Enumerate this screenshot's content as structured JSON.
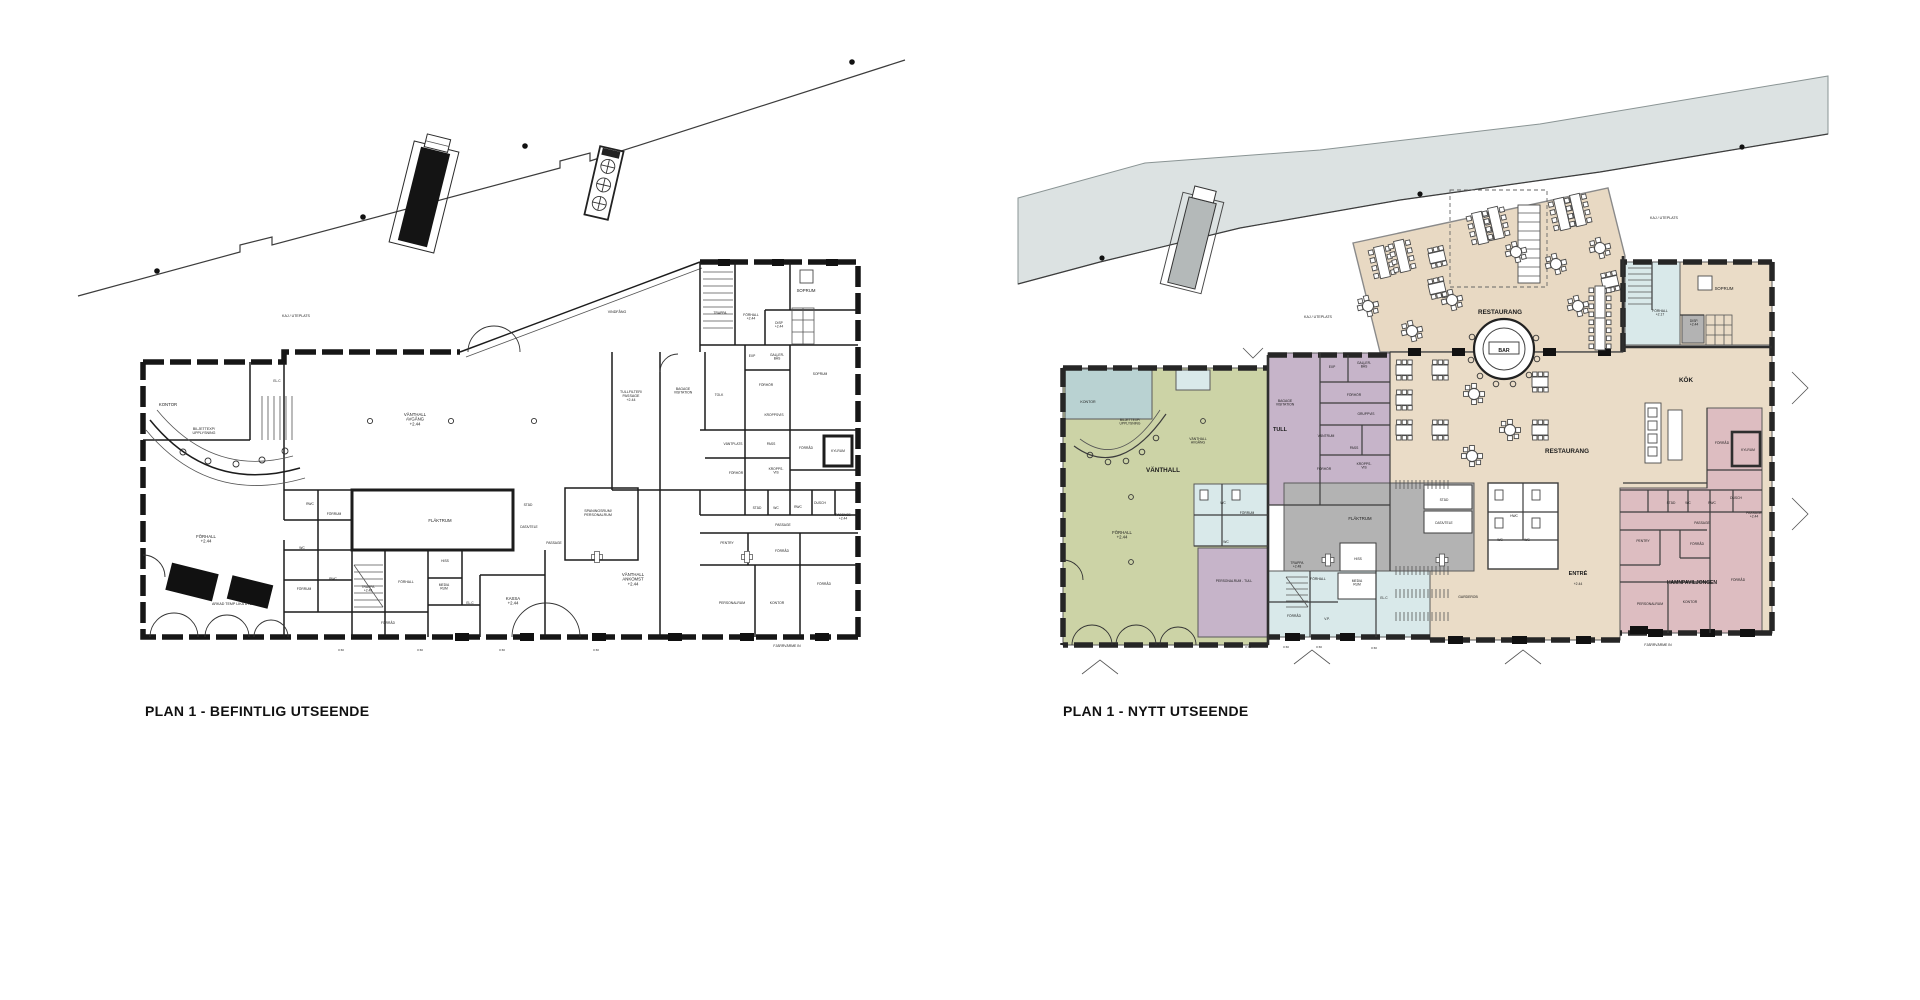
{
  "document": {
    "type": "architectural-floor-plan-comparison",
    "left_plan_name": "PLAN 1 - BEFINTLIG UTSEENDE",
    "right_plan_name": "PLAN 1 - NYTT UTSEENDE"
  },
  "colors": {
    "water": "#dce2e2",
    "deck": "#e8d9c3",
    "restaurant": "#eadcc7",
    "vanthall_green": "#ccd3a6",
    "kontor_teal": "#b9d2d2",
    "stair_light_blue": "#d9e9ea",
    "tull_purple": "#c6b4c9",
    "flaktrum_gray": "#b3b3b3",
    "hamnpaviljong_pink": "#ddbdc1",
    "walls": "#1f1f1f",
    "background": "#ffffff"
  },
  "left_plan": {
    "title": "PLAN 1 - BEFINTLIG UTSEENDE",
    "labels": [
      {
        "t": "KAJ / UTEPLATS",
        "x": 296,
        "y": 317,
        "s": 3.6
      },
      {
        "t": "VINDFÅNG",
        "x": 617,
        "y": 313,
        "s": 3.6
      },
      {
        "t": "VÄNTHALL\nAVGÅNG\n+2.44",
        "x": 415,
        "y": 416
      },
      {
        "t": "KONTOR",
        "x": 168,
        "y": 406
      },
      {
        "t": "BILJETTEXP/\nUPPLYSNING",
        "x": 204,
        "y": 430,
        "s": 3.6
      },
      {
        "t": "EL.C",
        "x": 277,
        "y": 382,
        "s": 3.3
      },
      {
        "t": "FÖRHALL\n+2.44",
        "x": 206,
        "y": 538
      },
      {
        "t": "ARKAD TEMP LIKA UTE",
        "x": 232,
        "y": 605,
        "s": 3.6
      },
      {
        "t": "RWC",
        "x": 310,
        "y": 505,
        "s": 3.3
      },
      {
        "t": "FÖRRUM",
        "x": 334,
        "y": 515,
        "s": 3.3
      },
      {
        "t": "WC",
        "x": 302,
        "y": 549,
        "s": 3.3
      },
      {
        "t": "RWC",
        "x": 333,
        "y": 580,
        "s": 3.3
      },
      {
        "t": "FÖRRUM",
        "x": 304,
        "y": 590,
        "s": 3.3
      },
      {
        "t": "TRAPPA\n+2.48",
        "x": 368,
        "y": 588,
        "s": 3.3
      },
      {
        "t": "FÖRHALL",
        "x": 406,
        "y": 583,
        "s": 3.4
      },
      {
        "t": "HISS",
        "x": 445,
        "y": 562,
        "s": 3.3
      },
      {
        "t": "MEDIA\nRUM",
        "x": 444,
        "y": 586,
        "s": 3.3
      },
      {
        "t": "EL.C",
        "x": 470,
        "y": 604,
        "s": 3.3
      },
      {
        "t": "KASSA\n+2.44",
        "x": 513,
        "y": 600
      },
      {
        "t": "FÖRRÅD",
        "x": 388,
        "y": 624,
        "s": 3.3
      },
      {
        "t": "FLÄKTRUM",
        "x": 440,
        "y": 522
      },
      {
        "t": "STÄD",
        "x": 528,
        "y": 506,
        "s": 3.3
      },
      {
        "t": "DATA/TELE",
        "x": 529,
        "y": 528,
        "s": 3.3
      },
      {
        "t": "PASSAGE",
        "x": 554,
        "y": 544,
        "s": 3.3
      },
      {
        "t": "SPANINGSRUM/\nPERSONALRUM",
        "x": 598,
        "y": 512,
        "s": 3.6
      },
      {
        "t": "VÄNTHALL\nANKOMST\n+2.44",
        "x": 633,
        "y": 576
      },
      {
        "t": "TULLFILTER/\nPASSAGE\n+2.44",
        "x": 631,
        "y": 393,
        "s": 3.6
      },
      {
        "t": "BAGAGE\nVISITATION",
        "x": 683,
        "y": 390,
        "s": 3.4
      },
      {
        "t": "TOLK",
        "x": 719,
        "y": 396,
        "s": 3.3
      },
      {
        "t": "FÖRHÖR",
        "x": 766,
        "y": 386,
        "s": 3.3
      },
      {
        "t": "EXP",
        "x": 752,
        "y": 357,
        "s": 3.3
      },
      {
        "t": "GALLER-\nBÅS",
        "x": 777,
        "y": 356,
        "s": 3.3
      },
      {
        "t": "SOPRUM",
        "x": 820,
        "y": 375,
        "s": 3.3
      },
      {
        "t": "KROPPSVIS",
        "x": 774,
        "y": 416,
        "s": 3.3
      },
      {
        "t": "VÄNTPLATS",
        "x": 733,
        "y": 445,
        "s": 3.3
      },
      {
        "t": "PASS",
        "x": 771,
        "y": 445,
        "s": 3.3
      },
      {
        "t": "FÖRHÖR",
        "x": 736,
        "y": 474,
        "s": 3.3
      },
      {
        "t": "KROPPS-\nVIS",
        "x": 776,
        "y": 470,
        "s": 3.3
      },
      {
        "t": "FÖRRÅD",
        "x": 806,
        "y": 449,
        "s": 3.3
      },
      {
        "t": "KYLRUM",
        "x": 838,
        "y": 452,
        "s": 3.3
      },
      {
        "t": "TRAPPA",
        "x": 720,
        "y": 314,
        "s": 3.3
      },
      {
        "t": "FÖRHALL\n+2.44",
        "x": 751,
        "y": 316,
        "s": 3.4
      },
      {
        "t": "SOPRUM",
        "x": 806,
        "y": 292
      },
      {
        "t": "DISP\n+2.44",
        "x": 779,
        "y": 324,
        "s": 3.3
      },
      {
        "t": "PENTRY",
        "x": 727,
        "y": 544,
        "s": 3.3
      },
      {
        "t": "STÄD",
        "x": 757,
        "y": 509,
        "s": 3.3
      },
      {
        "t": "WC",
        "x": 776,
        "y": 509,
        "s": 3.3
      },
      {
        "t": "RWC",
        "x": 798,
        "y": 508,
        "s": 3.3
      },
      {
        "t": "DUSCH",
        "x": 820,
        "y": 504,
        "s": 3.3
      },
      {
        "t": "PASSAGE",
        "x": 783,
        "y": 526,
        "s": 3.3
      },
      {
        "t": "PASSAGE\n+2.44",
        "x": 843,
        "y": 516,
        "s": 3.3
      },
      {
        "t": "FÖRRÅD",
        "x": 782,
        "y": 552,
        "s": 3.3
      },
      {
        "t": "FÖRRÅD",
        "x": 824,
        "y": 585,
        "s": 3.3
      },
      {
        "t": "PERSONALRUM",
        "x": 732,
        "y": 604,
        "s": 3.4
      },
      {
        "t": "KONTOR",
        "x": 777,
        "y": 604,
        "s": 3.4
      },
      {
        "t": "FJÄRRVÄRME IN",
        "x": 787,
        "y": 647,
        "s": 3.4
      },
      {
        "t": "0 60",
        "x": 341,
        "y": 651,
        "s": 3
      },
      {
        "t": "0 60",
        "x": 420,
        "y": 651,
        "s": 3
      },
      {
        "t": "0 60",
        "x": 502,
        "y": 651,
        "s": 3
      },
      {
        "t": "0 60",
        "x": 596,
        "y": 651,
        "s": 3
      }
    ]
  },
  "right_plan": {
    "title": "PLAN 1 - NYTT UTSEENDE",
    "labels": [
      {
        "t": "KAJ / UTEPLATS",
        "x": 1318,
        "y": 318,
        "s": 3.6
      },
      {
        "t": "KAJ / UTEPLATS",
        "x": 1664,
        "y": 219,
        "s": 3.6
      },
      {
        "t": "RESTAURANG",
        "x": 1500,
        "y": 314,
        "b": 1,
        "s": 6.3
      },
      {
        "t": "BAR",
        "x": 1504,
        "y": 352,
        "b": 1,
        "s": 5.2
      },
      {
        "t": "RESTAURANG",
        "x": 1567,
        "y": 453,
        "b": 1,
        "s": 6.3
      },
      {
        "t": "KÖK",
        "x": 1686,
        "y": 382,
        "b": 1,
        "s": 6.3
      },
      {
        "t": "VÄNTHALL",
        "x": 1163,
        "y": 472,
        "b": 1,
        "s": 6.3
      },
      {
        "t": "VÄNTHALL\nAVGÅNG",
        "x": 1198,
        "y": 440,
        "s": 3.4
      },
      {
        "t": "FÖRHALL\n+2.44",
        "x": 1122,
        "y": 534
      },
      {
        "t": "KONTOR",
        "x": 1088,
        "y": 403,
        "s": 3.6
      },
      {
        "t": "BILJETTEXP/\nUPPLYSNING",
        "x": 1130,
        "y": 421,
        "s": 3.3
      },
      {
        "t": "TULL",
        "x": 1280,
        "y": 431,
        "b": 1,
        "s": 5.5
      },
      {
        "t": "BAGAGE\nVISITATION",
        "x": 1285,
        "y": 402,
        "s": 3.4
      },
      {
        "t": "VÄNTRUM",
        "x": 1326,
        "y": 437,
        "s": 3.4
      },
      {
        "t": "FÖRHÖR",
        "x": 1354,
        "y": 396,
        "s": 3.3
      },
      {
        "t": "EXP",
        "x": 1332,
        "y": 368,
        "s": 3.3
      },
      {
        "t": "GALLER-\nBÅS",
        "x": 1364,
        "y": 364,
        "s": 3.3
      },
      {
        "t": "GRUPPVIS",
        "x": 1366,
        "y": 415,
        "s": 3.3
      },
      {
        "t": "PASS",
        "x": 1354,
        "y": 449,
        "s": 3.3
      },
      {
        "t": "FÖRHÖR",
        "x": 1324,
        "y": 470,
        "s": 3.3
      },
      {
        "t": "KROPPS-\nVIS",
        "x": 1364,
        "y": 465,
        "s": 3.3
      },
      {
        "t": "PERSONALRUM - TULL",
        "x": 1234,
        "y": 582,
        "s": 3.3
      },
      {
        "t": "WC",
        "x": 1223,
        "y": 504,
        "s": 3.3
      },
      {
        "t": "FÖRRUM",
        "x": 1247,
        "y": 514,
        "s": 3.3
      },
      {
        "t": "WC",
        "x": 1226,
        "y": 543,
        "s": 3.3
      },
      {
        "t": "FÖRRÅD",
        "x": 1294,
        "y": 617,
        "s": 3.3
      },
      {
        "t": "TRAPPA\n+2.48",
        "x": 1297,
        "y": 564,
        "s": 3.3
      },
      {
        "t": "FÖRHALL",
        "x": 1318,
        "y": 580,
        "s": 3.4
      },
      {
        "t": "HISS",
        "x": 1358,
        "y": 560,
        "s": 3.3
      },
      {
        "t": "MEDIA\nRUM",
        "x": 1357,
        "y": 582,
        "s": 3.3
      },
      {
        "t": "EL.C",
        "x": 1384,
        "y": 599,
        "s": 3.3
      },
      {
        "t": "V.P.",
        "x": 1327,
        "y": 620,
        "s": 3.3
      },
      {
        "t": "FLÄKTRUM",
        "x": 1360,
        "y": 520
      },
      {
        "t": "STÄD",
        "x": 1444,
        "y": 501,
        "s": 3.3
      },
      {
        "t": "DATA/TELE",
        "x": 1444,
        "y": 524,
        "s": 3.3
      },
      {
        "t": "GARDEROB",
        "x": 1468,
        "y": 598,
        "s": 3.4
      },
      {
        "t": "ENTRÉ",
        "x": 1578,
        "y": 575,
        "b": 1,
        "s": 5.5
      },
      {
        "t": "+2.44",
        "x": 1578,
        "y": 585,
        "s": 3.4
      },
      {
        "t": "HWC",
        "x": 1514,
        "y": 517,
        "s": 3.3
      },
      {
        "t": "WC",
        "x": 1500,
        "y": 541,
        "s": 3.3
      },
      {
        "t": "WC",
        "x": 1527,
        "y": 541,
        "s": 3.3
      },
      {
        "t": "SOPRUM",
        "x": 1724,
        "y": 290
      },
      {
        "t": "FÖRHALL\n+2.17",
        "x": 1660,
        "y": 312,
        "s": 3.4
      },
      {
        "t": "DISP.\n+2.44",
        "x": 1694,
        "y": 322,
        "s": 3.3
      },
      {
        "t": "FÖRRÅD",
        "x": 1722,
        "y": 444,
        "s": 3.4
      },
      {
        "t": "KYLRUM",
        "x": 1748,
        "y": 451,
        "s": 3.3
      },
      {
        "t": "STÄD",
        "x": 1671,
        "y": 504,
        "s": 3.3
      },
      {
        "t": "WC",
        "x": 1688,
        "y": 504,
        "s": 3.3
      },
      {
        "t": "RWC",
        "x": 1712,
        "y": 504,
        "s": 3.3
      },
      {
        "t": "DUSCH",
        "x": 1736,
        "y": 499,
        "s": 3.3
      },
      {
        "t": "PASSAGE",
        "x": 1702,
        "y": 524,
        "s": 3.3
      },
      {
        "t": "PASSAGE\n+2.44",
        "x": 1754,
        "y": 514,
        "s": 3.3
      },
      {
        "t": "PENTRY",
        "x": 1643,
        "y": 542,
        "s": 3.3
      },
      {
        "t": "FÖRRÅD",
        "x": 1697,
        "y": 545,
        "s": 3.3
      },
      {
        "t": "HAMNPAVILJONGEN",
        "x": 1692,
        "y": 584,
        "b": 1,
        "s": 5
      },
      {
        "t": "FÖRRÅD",
        "x": 1738,
        "y": 581,
        "s": 3.4
      },
      {
        "t": "PERSONALRUM",
        "x": 1650,
        "y": 605,
        "s": 3.4
      },
      {
        "t": "KONTOR",
        "x": 1690,
        "y": 603,
        "s": 3.4
      },
      {
        "t": "FJÄRRVÄRME IN",
        "x": 1658,
        "y": 646,
        "s": 3.4
      },
      {
        "t": "0 60",
        "x": 1248,
        "y": 648,
        "s": 3
      },
      {
        "t": "0 60",
        "x": 1286,
        "y": 648,
        "s": 3
      },
      {
        "t": "0 60",
        "x": 1319,
        "y": 648,
        "s": 3
      },
      {
        "t": "0 60",
        "x": 1374,
        "y": 649,
        "s": 3
      }
    ]
  }
}
